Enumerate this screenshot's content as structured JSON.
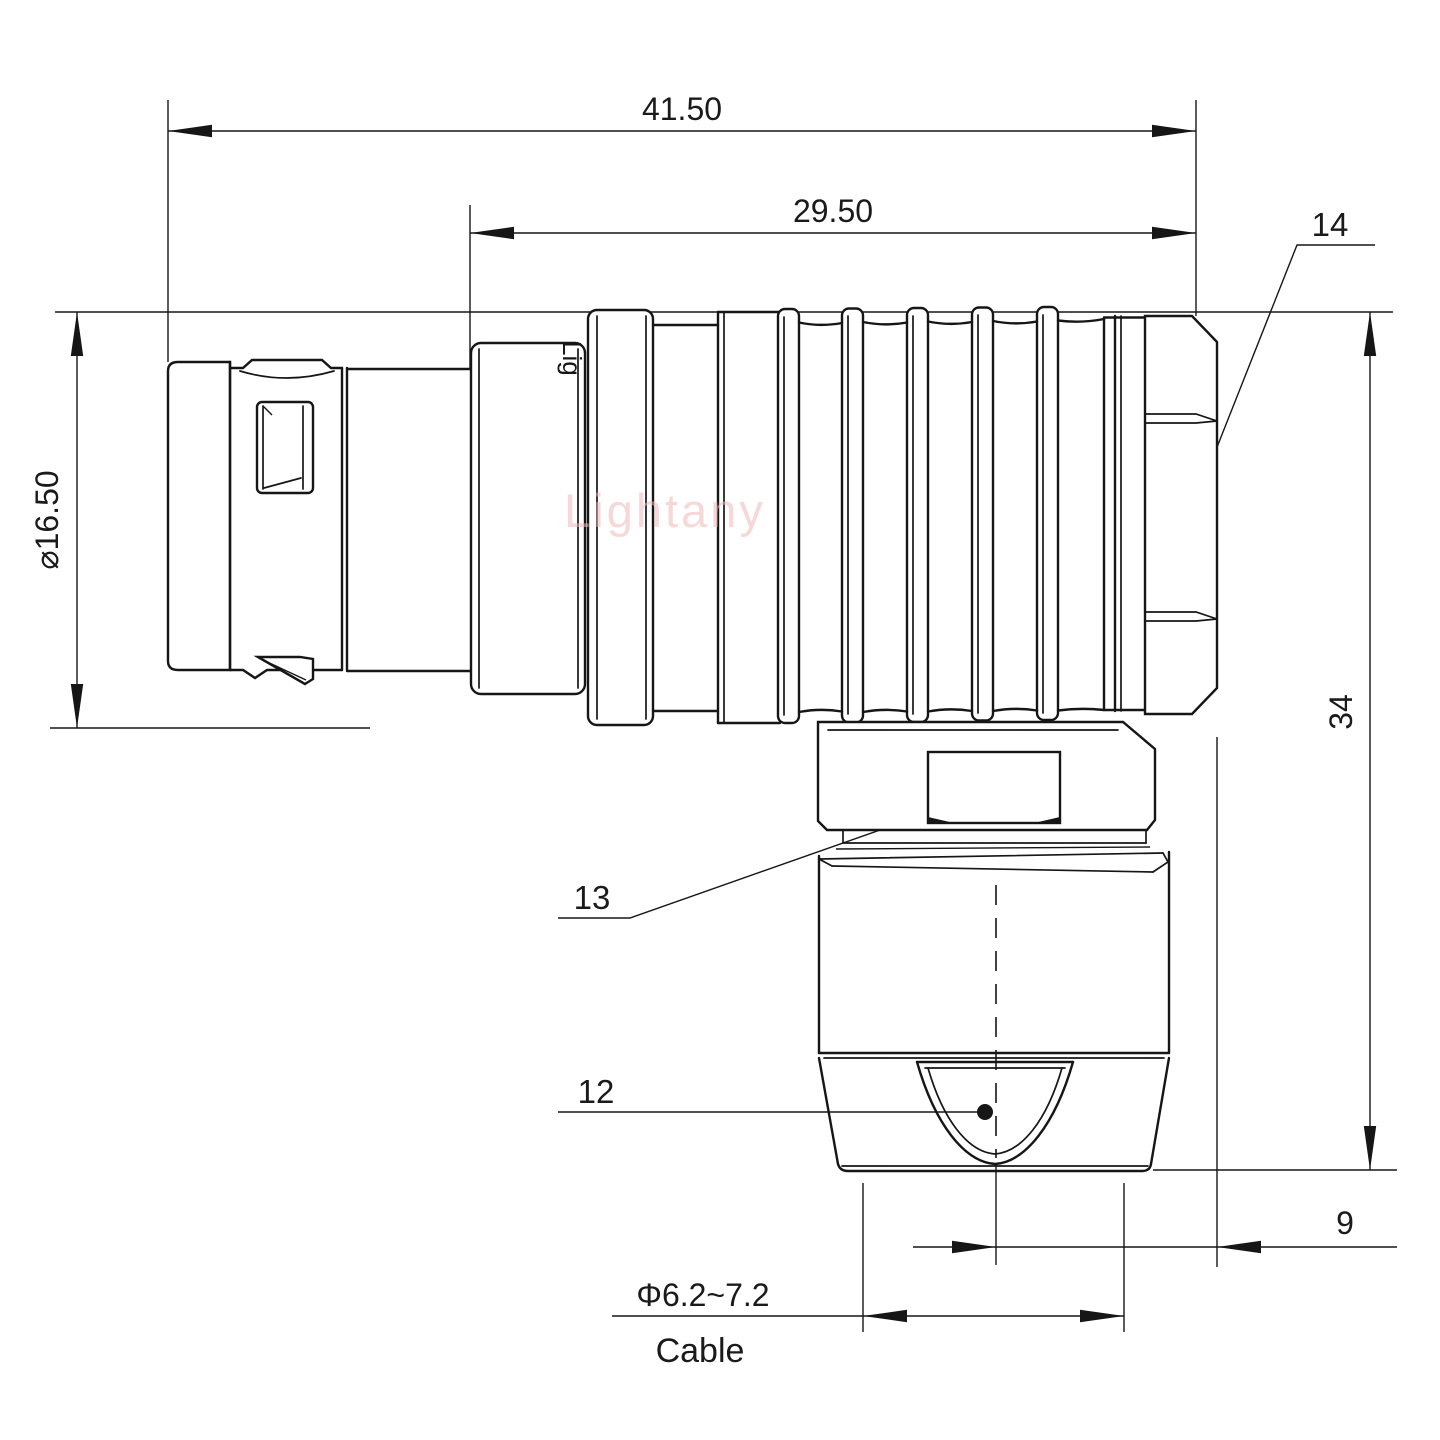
{
  "drawing": {
    "watermark": "Lightany",
    "engraving": "Lig",
    "dimensions": {
      "overall_length": "41.50",
      "body_length": "29.50",
      "diameter": "⌀16.50",
      "height": "34",
      "offset": "9",
      "cable_range": "Φ6.2~7.2",
      "cable_label": "Cable"
    },
    "callouts": {
      "hex_coupling": "14",
      "backnut": "13",
      "cable_clamp": "12"
    },
    "colors": {
      "line": "#161616",
      "watermark": "#f0b9b9",
      "background": "#ffffff"
    }
  }
}
